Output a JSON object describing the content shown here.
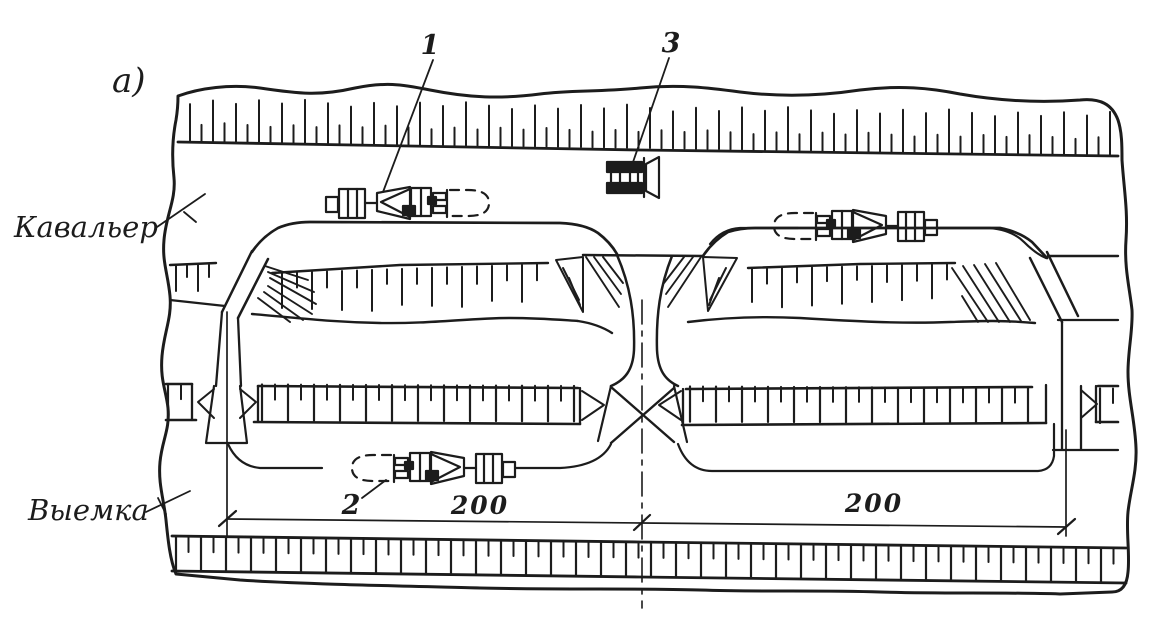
{
  "figure": {
    "panel_label": "а)",
    "labels": {
      "cavalier": "Кавальер",
      "excavation": "Выемка"
    },
    "callouts": {
      "scraper_on_cavalier": "1",
      "scraper_in_cut": "2",
      "bulldozer": "3"
    },
    "dimensions": {
      "left_span": "200",
      "right_span": "200"
    },
    "machines": [
      {
        "callout": "1",
        "icon": "scraper-icon",
        "location": "cavalier-berm-left",
        "heading": "left"
      },
      {
        "callout": "3",
        "icon": "bulldozer-icon",
        "location": "cavalier-berm-center",
        "heading": "right"
      },
      {
        "callout": "",
        "icon": "scraper-icon",
        "location": "cavalier-berm-right",
        "heading": "right"
      },
      {
        "callout": "2",
        "icon": "scraper-icon",
        "location": "excavation-floor",
        "heading": "right"
      }
    ],
    "colors": {
      "ink": "#1c1c1c",
      "paper": "#ffffff"
    }
  }
}
